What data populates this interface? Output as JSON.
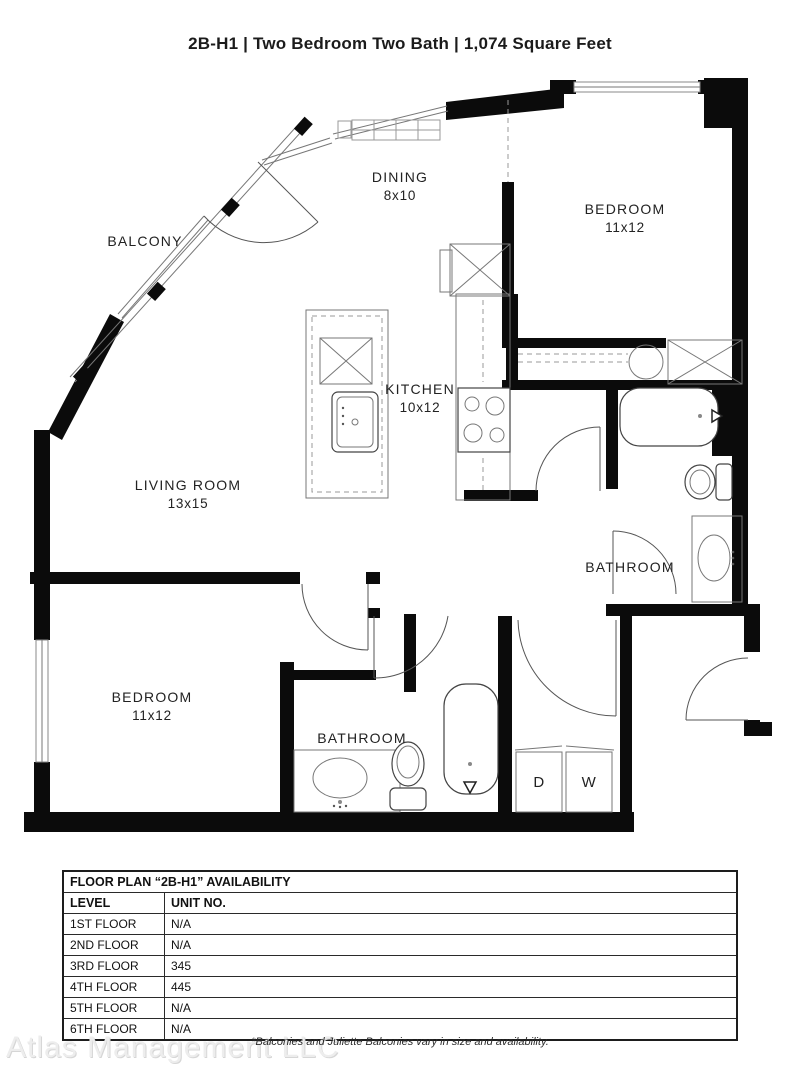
{
  "title": "2B-H1 | Two Bedroom Two Bath | 1,074 Square Feet",
  "plan": {
    "balcony_label": "BALCONY",
    "dining_label": "DINING",
    "dining_dims": "8x10",
    "bedroom1_label": "BEDROOM",
    "bedroom1_dims": "11x12",
    "kitchen_label": "KITCHEN",
    "kitchen_dims": "10x12",
    "living_label": "LIVING ROOM",
    "living_dims": "13x15",
    "bathroom1_label": "BATHROOM",
    "bedroom2_label": "BEDROOM",
    "bedroom2_dims": "11x12",
    "bathroom2_label": "BATHROOM",
    "dryer_label": "D",
    "washer_label": "W"
  },
  "table": {
    "title": "FLOOR PLAN “2B-H1” AVAILABILITY",
    "col_level": "LEVEL",
    "col_unit": "UNIT NO.",
    "rows": [
      {
        "level": "1ST FLOOR",
        "unit": "N/A"
      },
      {
        "level": "2ND FLOOR",
        "unit": "N/A"
      },
      {
        "level": "3RD FLOOR",
        "unit": "345"
      },
      {
        "level": "4TH FLOOR",
        "unit": "445"
      },
      {
        "level": "5TH FLOOR",
        "unit": "N/A"
      },
      {
        "level": "6TH FLOOR",
        "unit": "N/A"
      }
    ]
  },
  "footer": {
    "watermark": "Atlas Management LLC",
    "note": "*Balconies and Juliette Balconies vary in size and availability."
  }
}
